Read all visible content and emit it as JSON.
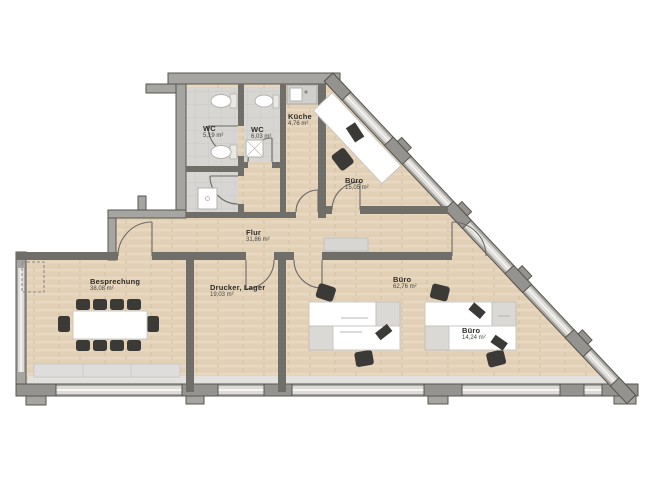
{
  "floorplan": {
    "type": "office-floor-plan",
    "rooms": [
      {
        "id": "wc-1",
        "name": "WC",
        "area": "5,19 m²"
      },
      {
        "id": "wc-2",
        "name": "WC",
        "area": "6,03 m²"
      },
      {
        "id": "kueche",
        "name": "Küche",
        "area": "4,76 m²"
      },
      {
        "id": "buero-oben",
        "name": "Büro",
        "area": "15,05 m²"
      },
      {
        "id": "flur",
        "name": "Flur",
        "area": "31,86 m²"
      },
      {
        "id": "besprechung",
        "name": "Besprechung",
        "area": "38,08 m²"
      },
      {
        "id": "drucker-lager",
        "name": "Drucker, Lager",
        "area": "19,03 m²"
      },
      {
        "id": "buero-gross",
        "name": "Büro",
        "area": "62,76 m²"
      },
      {
        "id": "buero-klein",
        "name": "Büro",
        "area": "14,24 m²"
      }
    ],
    "colors": {
      "wood_floor": "#e8d8c0",
      "tile_floor": "#d7d6d2",
      "exterior_wall": "#a6a5a1",
      "wall_outline": "#57564e",
      "interior_wall": "#6f6e68",
      "window_glass": "#dddcd8",
      "furniture_dark": "#3b3a36",
      "desk_white": "#ffffff",
      "background": "#ffffff"
    }
  }
}
